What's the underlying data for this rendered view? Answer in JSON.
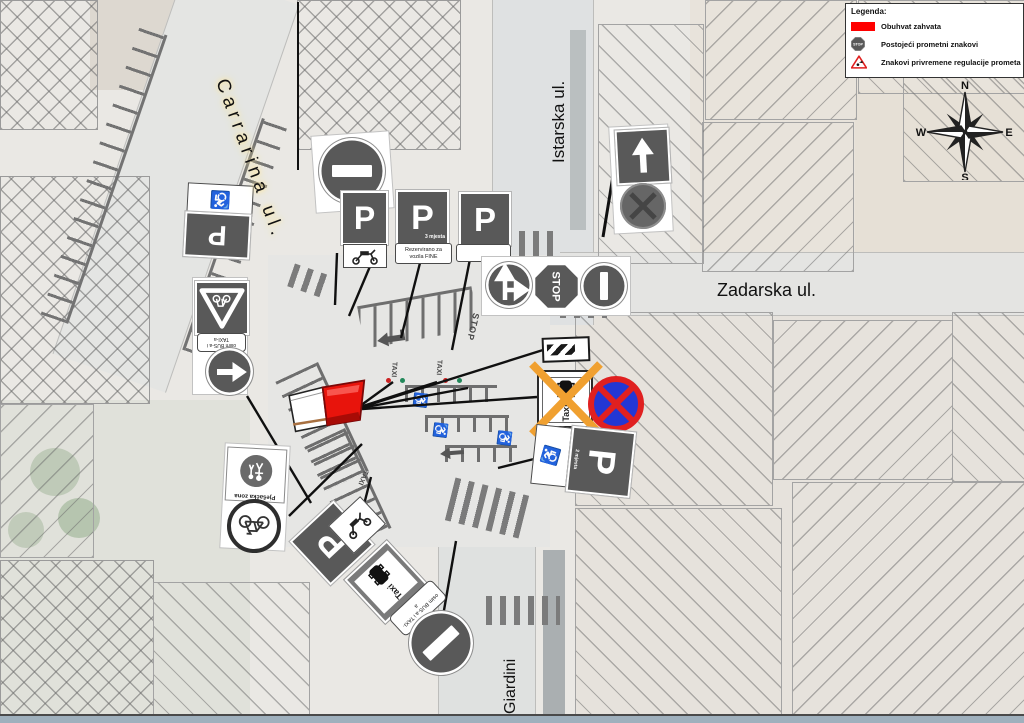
{
  "legend": {
    "title": "Legenda:",
    "items": [
      {
        "label": "Obuhvat zahvata",
        "icon": "work-area-red-rectangle"
      },
      {
        "label": "Postojeći prometni znakovi",
        "icon": "existing-stop-sign"
      },
      {
        "label": "Znakovi privremene regulacije prometa",
        "icon": "temporary-roadworks-triangle"
      }
    ]
  },
  "compass": {
    "n": "N",
    "e": "E",
    "s": "S",
    "w": "W"
  },
  "streets": {
    "carrarina": "Carrarina ul.",
    "istarska": "Istarska ul.",
    "zadarska": "Zadarska ul.",
    "giardini": "Giardini"
  },
  "signs": {
    "p": "P",
    "stop": "STOP",
    "p_places_3": "3 mjesta",
    "p_plate_reserved": "Rezervirano za vozila FINE",
    "p_places_2": "2 mjesta",
    "bus_taxi_plate": "osim BUS-a i TAXI-a",
    "pedestrian_zone": "Pješačka zona",
    "taxi": "Taxi"
  },
  "road_markings": {
    "stop": "STOP",
    "taxi": "TAXI"
  },
  "icons": {
    "wheelchair": "♿"
  },
  "colors": {
    "work_area_red": "#e8140c",
    "temporary_orange": "#f0a030",
    "no_stopping_blue": "#2337d4",
    "no_stopping_red": "#e02020",
    "sign_gray": "#595959"
  }
}
